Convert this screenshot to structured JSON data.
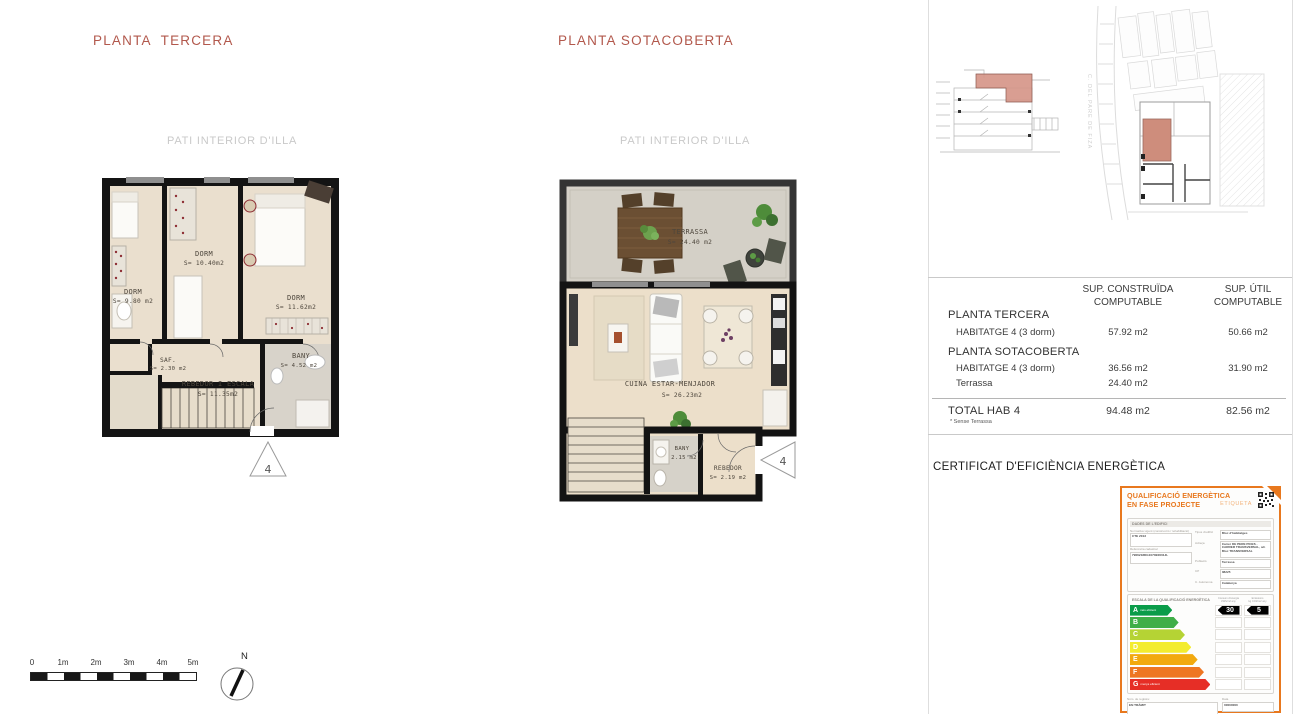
{
  "sheet": {
    "colors": {
      "title_red": "#b2584c",
      "cert_orange": "#e8781e",
      "highlight_salmon": "#d08b7c"
    },
    "plans": [
      {
        "title": "PLANTA  TERCERA",
        "context": "PATI INTERIOR D'ILLA",
        "marker": "4",
        "rooms": {
          "dorm1": {
            "name": "DORM",
            "area": "S= 9.80 m2"
          },
          "dorm2": {
            "name": "DORM",
            "area": "S= 10.40m2"
          },
          "dorm3": {
            "name": "DORM",
            "area": "S= 11.62m2"
          },
          "saf": {
            "name": "SAF.",
            "area": "S= 2.30 m2"
          },
          "rebedor": {
            "name": "REBEDOR  I  ESCALA",
            "area": "S= 11.35m2"
          },
          "bany": {
            "name": "BANY",
            "area": "S= 4.52 m2"
          }
        }
      },
      {
        "title": "PLANTA SOTACOBERTA",
        "context": "PATI INTERIOR D'ILLA",
        "marker": "4",
        "rooms": {
          "terrassa": {
            "name": "TERRASSA",
            "area": "S= 24.40 m2"
          },
          "cuina": {
            "name": "CUINA ESTAR-MENJADOR",
            "area": "S= 26.23m2"
          },
          "bany": {
            "name": "BANY",
            "area": "2.15 m2"
          },
          "rebedor": {
            "name": "REBEDOR",
            "area": "S= 2.19  m2"
          }
        }
      }
    ],
    "scale_bar": {
      "labels": [
        "0",
        "1m",
        "2m",
        "3m",
        "4m",
        "5m"
      ]
    },
    "north": "N",
    "site": {
      "street": "C. DEL PARE DE FIZA"
    },
    "areas_table": {
      "header_built_1": "SUP. CONSTRUÏDA",
      "header_built_2": "COMPUTABLE",
      "header_useful_1": "SUP. ÚTIL",
      "header_useful_2": "COMPUTABLE",
      "section1": "PLANTA TERCERA",
      "row1": {
        "label": "HABITATGE 4   (3 dorm)",
        "built": "57.92 m2",
        "useful": "50.66 m2"
      },
      "section2": "PLANTA SOTACOBERTA",
      "row2": {
        "label": "HABITATGE 4   (3 dorm)",
        "built": "36.56 m2",
        "useful": "31.90 m2"
      },
      "row3": {
        "label": "Terrassa",
        "built": "24.40 m2",
        "useful": ""
      },
      "total": {
        "label": "TOTAL HAB 4",
        "built": "94.48 m2",
        "useful": "82.56 m2",
        "note": "* Sense Terrassa"
      }
    },
    "cert_heading": "CERTIFICAT D'EFICIÈNCIA ENERGÈTICA",
    "energy_label": {
      "title1": "QUALIFICACIÓ ENERGÈTICA",
      "title2": "EN FASE PROJECTE",
      "tag": "ETIQUETA",
      "building": {
        "section": "DADES DE L'EDIFICI",
        "left": [
          {
            "label": "Normativa vigent (construcció / rehabilitació)",
            "value": "CTE 2013"
          },
          {
            "label": "Referència cadastral",
            "value": "7906218DG1070E0001JL"
          }
        ],
        "right": [
          {
            "label": "Tipus d'edifici",
            "value": "Bloc d'habitatges"
          },
          {
            "label": "Adreça",
            "value": "Carrer DE PERE PICES - CARRER TRANSVERSAL, s/n Bloc TRANSVERSAL"
          },
          {
            "label": "Població",
            "value": "Terrassa"
          },
          {
            "label": "CP",
            "value": "08225"
          },
          {
            "label": "C. Autònoma",
            "value": "Catalunya"
          }
        ]
      },
      "scale": {
        "section": "ESCALA DE LA QUALIFICACIÓ ENERGÈTICA",
        "col1a": "Consum d'energia",
        "col1b": "kWh/m2 any",
        "col2a": "Emissions",
        "col2b": "kg CO2/m2 any",
        "rows": [
          {
            "letter": "A",
            "note": "més eficient",
            "color": "#0a9c49",
            "width": 30,
            "consum": "30",
            "emissions": "5"
          },
          {
            "letter": "B",
            "note": "",
            "color": "#3fae47",
            "width": 34.5
          },
          {
            "letter": "C",
            "note": "",
            "color": "#b5d334",
            "width": 39
          },
          {
            "letter": "D",
            "note": "",
            "color": "#f3ec2e",
            "width": 43.5
          },
          {
            "letter": "E",
            "note": "",
            "color": "#f2a90f",
            "width": 48
          },
          {
            "letter": "F",
            "note": "",
            "color": "#ee7623",
            "width": 52.5
          },
          {
            "letter": "G",
            "note": "menys eficient",
            "color": "#e62e26",
            "width": 57
          }
        ]
      },
      "reg": {
        "left_label": "Núm. de registre:",
        "left_value": "EN TRÀMIT",
        "right_label": "Data",
        "right_value": "00000000"
      },
      "footer": {
        "org1": "Generalitat de Catalunya",
        "org2": "Institut Català d'Energia",
        "right1": "ICAEN",
        "right2": "2018 1.1.1 ca"
      }
    }
  }
}
